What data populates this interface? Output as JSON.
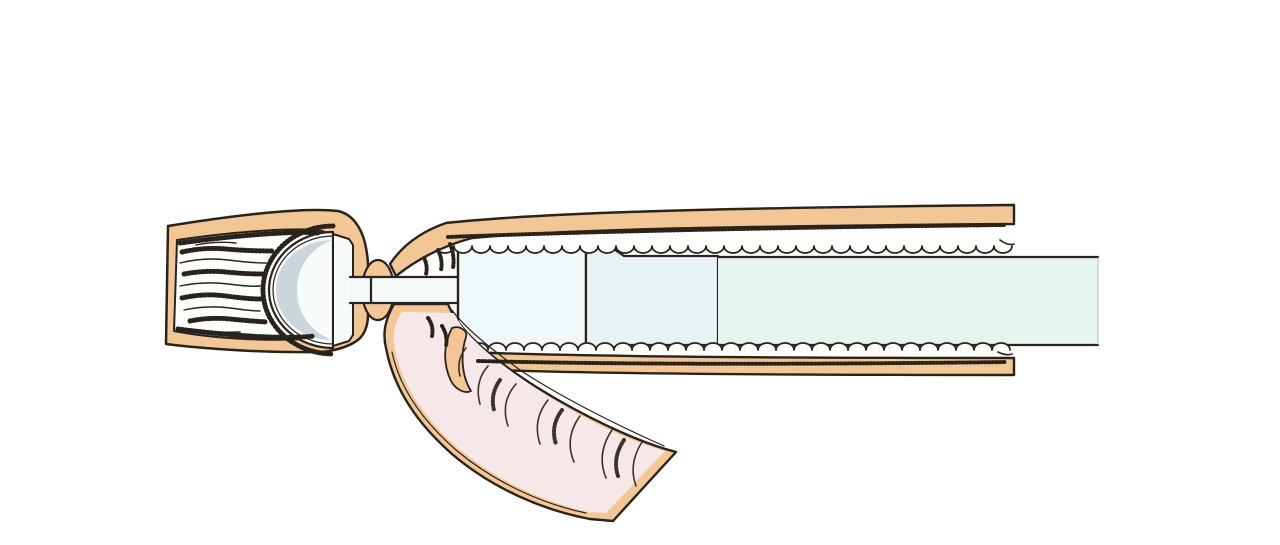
{
  "illustration": {
    "type": "surgical-stapler-anastomosis-diagram",
    "parts": {
      "left_bowel": "bowel-segment-holding-anvil",
      "anvil_head": "circular-stapler-anvil-dome",
      "anvil_rod": "anvil-center-rod",
      "purse_string": "purse-string-knot-around-rod",
      "cartridge": "stapler-cartridge-head",
      "body": "stapler-body-collar",
      "shaft": "stapler-long-shaft",
      "main_bowel": "bowel-segment-around-stapler",
      "side_limb": "open-side-bowel-limb"
    }
  },
  "colors": {
    "background": "#ffffff",
    "bowel_wall": "#f2c795",
    "outline_ink": "#29231c",
    "lumen_white": "#fdfdfb",
    "mucosa_pink": "#f6e7e9",
    "anvil_white": "#f7fbfb",
    "anvil_shade": "#ccd6da",
    "rod_white": "#f4f9fa",
    "cartridge_blue": "#f1f9fb",
    "body_blue": "#e7f2f5",
    "shaft_mint": "#e5f4ed",
    "shaft_edge": "#b9cfc6",
    "fold_ink": "#3a322b"
  }
}
